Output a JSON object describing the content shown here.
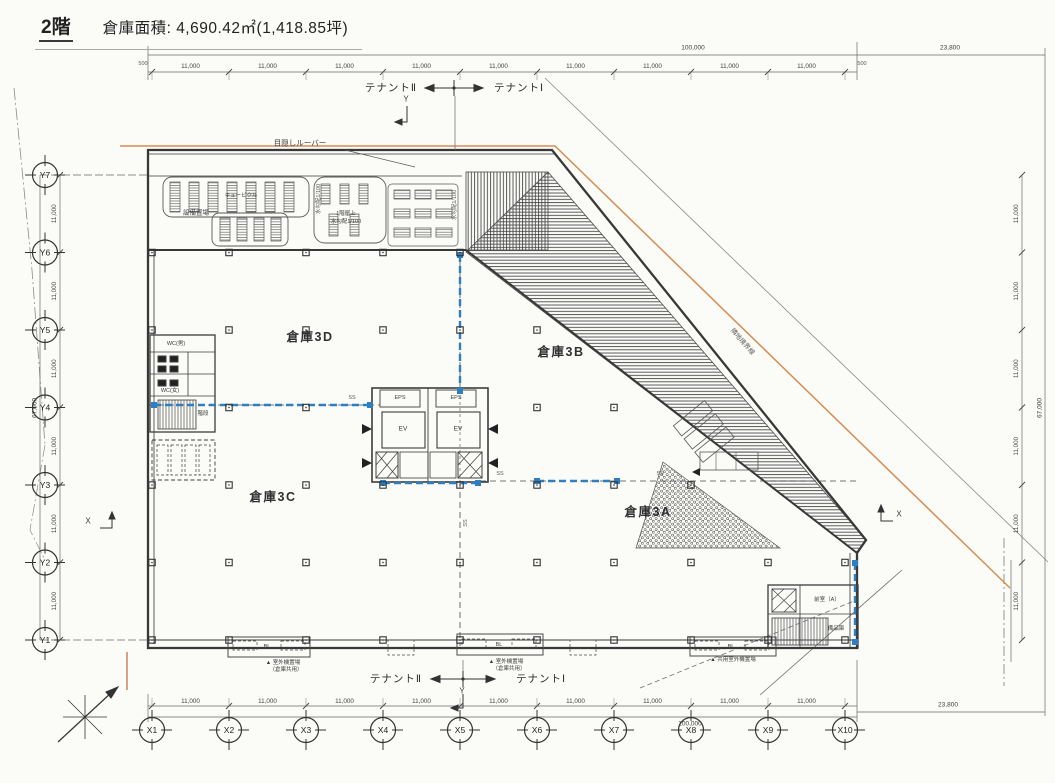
{
  "header": {
    "floor": "2階",
    "area": "倉庫面積: 4,690.42㎡(1,418.85坪)"
  },
  "tenants": {
    "left": "テナントⅡ",
    "right": "テナントⅠ"
  },
  "grid": {
    "x": [
      "X1",
      "X2",
      "X3",
      "X4",
      "X5",
      "X6",
      "X7",
      "X8",
      "X9",
      "X10"
    ],
    "y": [
      "Y7",
      "Y6",
      "Y5",
      "Y4",
      "Y3",
      "Y2",
      "Y1"
    ]
  },
  "dims": {
    "bay": "11,000",
    "total": "100,000",
    "ext": "23,800",
    "height_total": "67,000",
    "half": "500"
  },
  "rooms": {
    "w3d": "倉庫3D",
    "w3b": "倉庫3B",
    "w3c": "倉庫3C",
    "w3a": "倉庫3A",
    "eps": "EPS",
    "ev": "EV",
    "wc_m": "WC(男)",
    "wc_f": "WC(女)",
    "stair": "階段",
    "ante": "前室（A）",
    "bihin": "備品庫"
  },
  "notes": {
    "louver": "目隠しルーバー",
    "equip": "設備置場",
    "cubicle": "キュービクル",
    "roof1": "1階屋上",
    "roof2": "水勾配1/100",
    "slope": "水勾配1/100",
    "out1": "▲ 室外機置場",
    "out1b": "（倉庫共用）",
    "out2": "▲ 共用室外機置場",
    "bl": "BL",
    "ss": "SS",
    "boundary": "隣地境界線",
    "axis_x": "X",
    "axis_y": "Y"
  }
}
